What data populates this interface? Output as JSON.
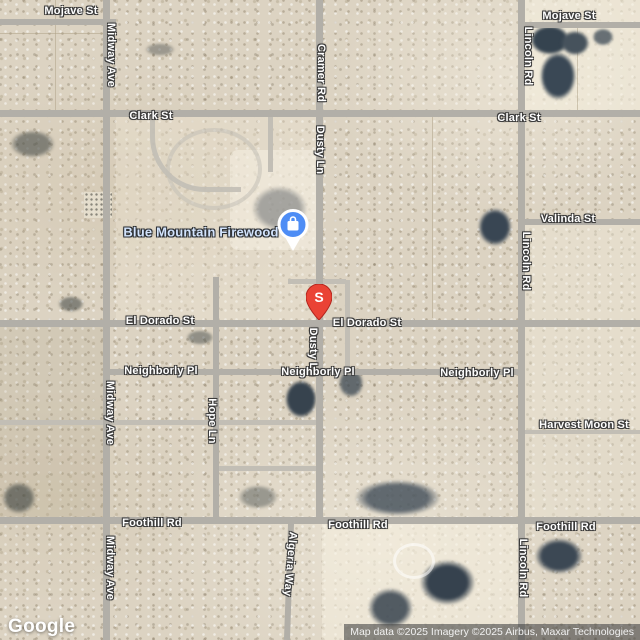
{
  "streets": {
    "mojave": "Mojave St",
    "midway": "Midway Ave",
    "clark": "Clark St",
    "cramer": "Cramer Rd",
    "dusty": "Dusty Ln",
    "lincoln": "Lincoln Rd",
    "valinda": "Valinda St",
    "el_dorado": "El Dorado St",
    "neighborly": "Neighborly Pl",
    "hope": "Hope Ln",
    "harvest_moon": "Harvest Moon St",
    "foothill": "Foothill Rd",
    "algeria": "Algeria Way"
  },
  "poi": {
    "name": "Blue Mountain Firewood",
    "icon": "shopping-bag-icon",
    "color": "#4e8df5"
  },
  "marker": {
    "label": "S",
    "color": "#ea4335"
  },
  "branding": {
    "logo_text": "Google"
  },
  "attribution": {
    "text": "Map data ©2025 Imagery ©2025 Airbus, Maxar Technologies"
  },
  "colors": {
    "terrain": "#dcd3c2",
    "road": "#b2afa8",
    "minor_road": "#c2beb5",
    "street_label": "#ffffff",
    "label_outline": "#3b3b3b",
    "poi_label": "#d2e3fc"
  }
}
